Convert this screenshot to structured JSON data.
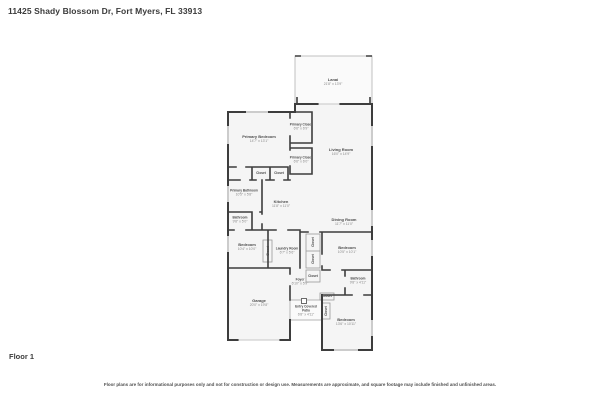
{
  "header": {
    "title": "11425 Shady Blossom Dr, Fort Myers, FL 33913"
  },
  "floor": {
    "label": "Floor 1"
  },
  "disclaimer": "Floor plans are for informational purposes only and not for construction or design use. Measurements are approximate, and square footage may include finished and unfinished areas.",
  "colors": {
    "wall": "#3d3d3d",
    "floor_fill": "#f5f5f5",
    "lanai_wall": "#c0c0c0",
    "window": "#cccccc",
    "room_name_text": "#4c4c4c",
    "room_dim_text": "#8a8a8a"
  },
  "floorplan": {
    "rooms": [
      {
        "name": "Lanai",
        "dims": "21'8\" x 13'9\""
      },
      {
        "name": "Primary Bedroom",
        "dims": "14'7\" x 13'1\""
      },
      {
        "name": "Primary Closet",
        "dims": "6'6\" x 6'9\""
      },
      {
        "name": "Primary Closet",
        "dims": "6'6\" x 6'0\""
      },
      {
        "name": "Living Room",
        "dims": "16'0\" x 14'9\""
      },
      {
        "name": "Primary Bathroom",
        "dims": "10'5\" x 5'8\""
      },
      {
        "name": "Closet",
        "dims": ""
      },
      {
        "name": "Closet",
        "dims": ""
      },
      {
        "name": "Kitchen",
        "dims": "11'8\" x 11'0\""
      },
      {
        "name": "Bathroom",
        "dims": "9'8\" x 5'0\""
      },
      {
        "name": "Dining Room",
        "dims": "11'7\" x 11'0\""
      },
      {
        "name": "Bedroom",
        "dims": "10'4\" x 10'0\""
      },
      {
        "name": "Closet",
        "dims": ""
      },
      {
        "name": "Laundry Room",
        "dims": "6'7\" x 5'6\""
      },
      {
        "name": "Closet",
        "dims": ""
      },
      {
        "name": "Closet",
        "dims": ""
      },
      {
        "name": "Bedroom",
        "dims": "10'5\" x 10'1\""
      },
      {
        "name": "Closet",
        "dims": ""
      },
      {
        "name": "Foyer",
        "dims": "6'10\" x 5'9\""
      },
      {
        "name": "Bathroom",
        "dims": "9'8\" x 4'11\""
      },
      {
        "name": "Garage",
        "dims": "20'0\" x 19'8\""
      },
      {
        "name": "Closet",
        "dims": ""
      },
      {
        "name": "Closet",
        "dims": ""
      },
      {
        "name": "Entry Covered Patio",
        "dims": "6'8\" x 4'11\""
      },
      {
        "name": "Bedroom",
        "dims": "13'6\" x 10'11\""
      }
    ]
  }
}
